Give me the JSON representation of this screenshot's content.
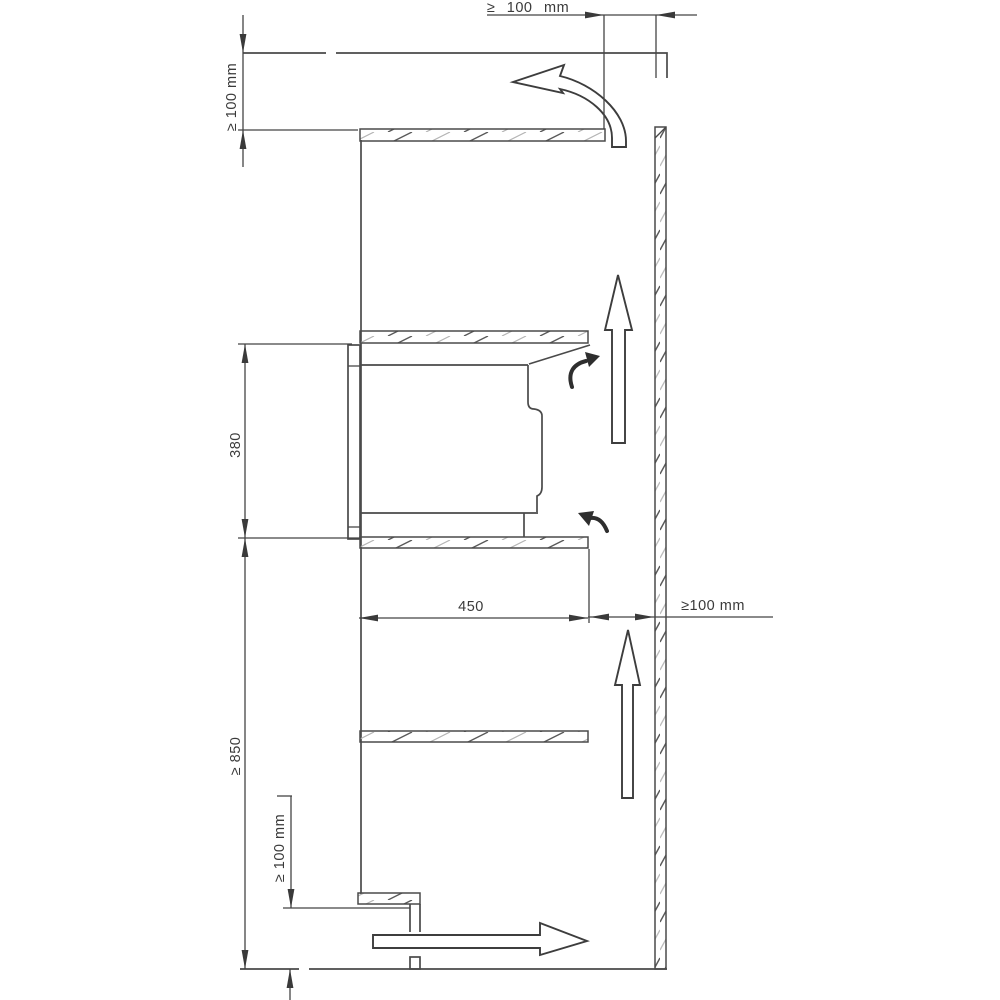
{
  "diagram": {
    "type": "installation-clearance-drawing",
    "labels": {
      "top_clearance": "≥ 100 mm",
      "upper_left_clearance": "≥ 100 mm",
      "oven_niche_height": "380",
      "niche_depth": "450",
      "rear_wall_clearance": "≥100 mm",
      "worktop_height": "≥ 850",
      "plinth_clearance": "≥ 100 mm"
    },
    "colors": {
      "background": "#ffffff",
      "line": "#4a4a4a",
      "text": "#3a3a3a",
      "hatch_light": "#b4b4b4"
    }
  }
}
